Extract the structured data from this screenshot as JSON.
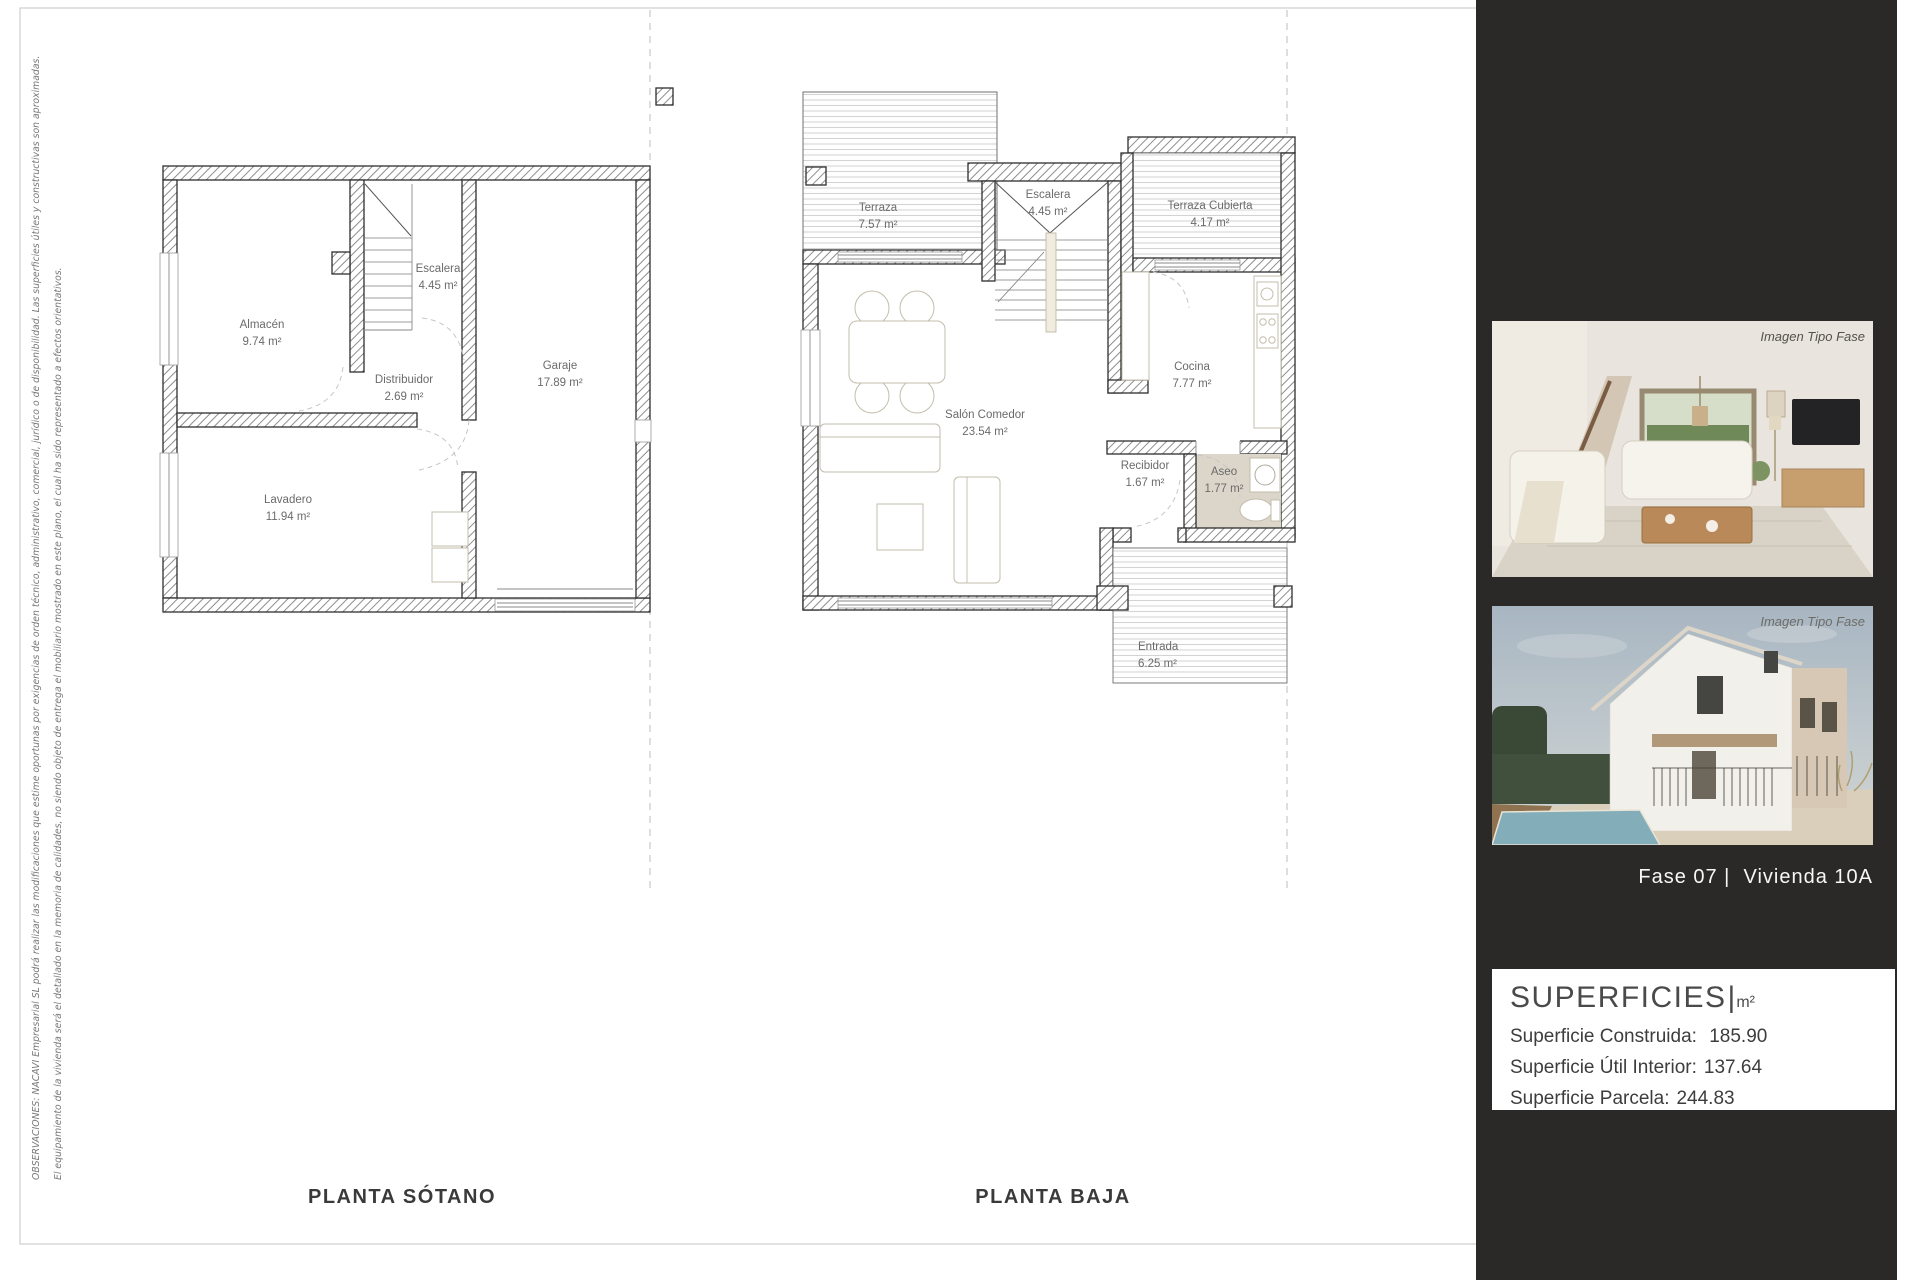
{
  "document": {
    "notes": {
      "line1": "OBSERVACIONES: NACAVI Empresarial SL podrá realizar las modificaciones que estime oportunas por exigencias de orden técnico, administrativo, comercial, jurídico o de disponibilidad. Las superficies útiles y constructivas son aproximadas.",
      "line2": "El equipamiento de la vivienda será el detallado en la memoria de calidades, no siendo objeto de entrega el mobiliario mostrado en este plano, el  cual ha sido representado a efectos orientativos."
    }
  },
  "plans": {
    "sotano": {
      "title": "PLANTA SÓTANO",
      "rooms": [
        {
          "name": "Almacén",
          "area": "9.74 m²"
        },
        {
          "name": "Escalera",
          "area": "4.45 m²"
        },
        {
          "name": "Distribuidor",
          "area": "2.69 m²"
        },
        {
          "name": "Garaje",
          "area": "17.89 m²"
        },
        {
          "name": "Lavadero",
          "area": "11.94 m²"
        }
      ]
    },
    "baja": {
      "title": "PLANTA BAJA",
      "rooms": [
        {
          "name": "Terraza",
          "area": "7.57 m²"
        },
        {
          "name": "Escalera",
          "area": "4.45 m²"
        },
        {
          "name": "Terraza Cubierta",
          "area": "4.17 m²"
        },
        {
          "name": "Salón Comedor",
          "area": "23.54 m²"
        },
        {
          "name": "Cocina",
          "area": "7.77 m²"
        },
        {
          "name": "Recibidor",
          "area": "1.67 m²"
        },
        {
          "name": "Aseo",
          "area": "1.77 m²"
        },
        {
          "name": "Entrada",
          "area": "6.25 m²"
        }
      ]
    }
  },
  "sidebar": {
    "images": [
      {
        "label": "Imagen Tipo Fase",
        "subject": "living-room-render"
      },
      {
        "label": "Imagen Tipo Fase",
        "subject": "house-exterior-render"
      }
    ],
    "caption": "Fase 07 |  Vivienda 10A",
    "superficies": {
      "title": "SUPERFICIES",
      "unit": "m²",
      "rows": [
        {
          "label": "Superficie Construida:",
          "value": " 185.90"
        },
        {
          "label": "Superficie Útil Interior:",
          "value": "137.64"
        },
        {
          "label": "Superficie Parcela:",
          "value": "244.83"
        }
      ]
    }
  },
  "colors": {
    "sidebar_bg": "#2b2928",
    "wall_line": "#2e2e2e",
    "aseo_floor": "#dcd5ca",
    "dashed_separator": "#bdbdbd"
  }
}
